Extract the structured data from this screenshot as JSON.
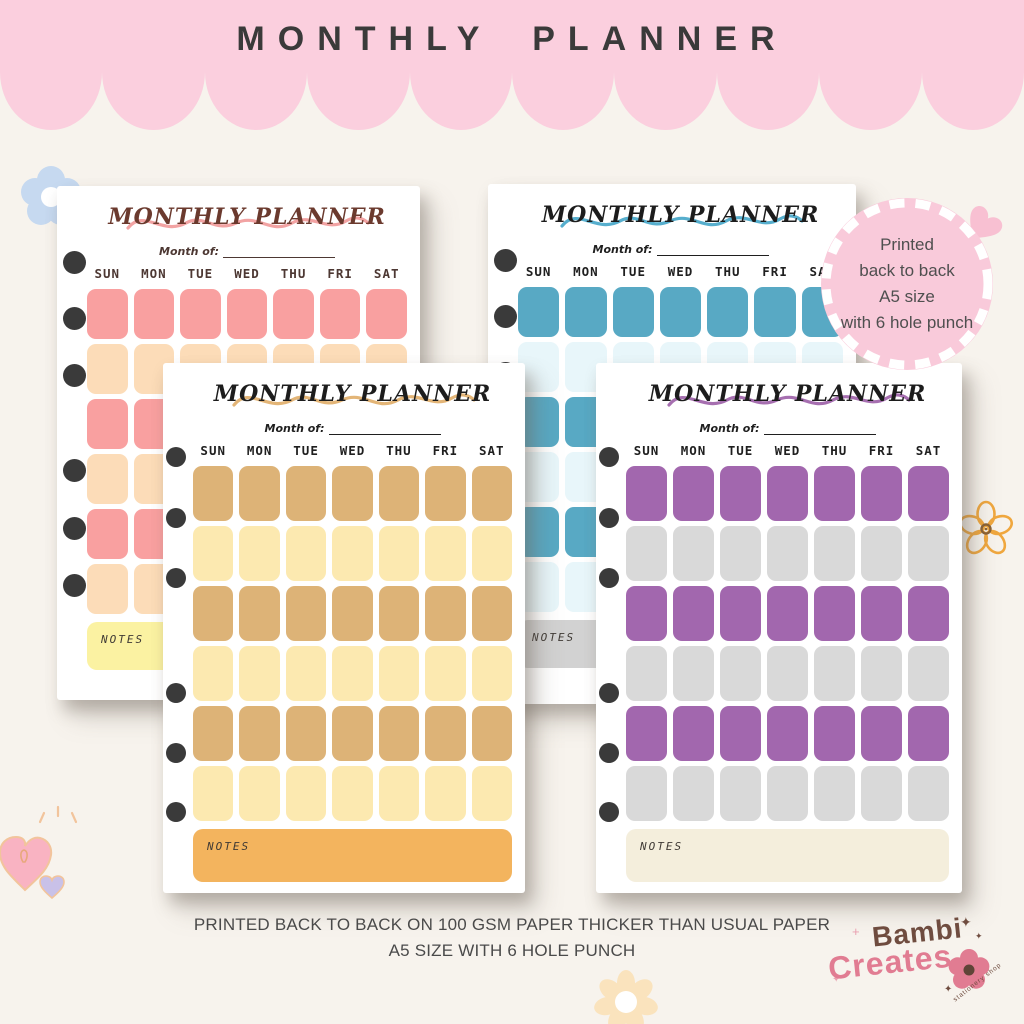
{
  "header": {
    "title": "MONTHLY PLANNER"
  },
  "badge": {
    "lines": [
      "Printed",
      "back to back",
      "A5 size",
      "with 6 hole punch"
    ]
  },
  "planners": [
    {
      "id": "pink",
      "title": "MONTHLY PLANNER",
      "month_label": "Month of:",
      "notes_label": "NOTES",
      "days": [
        "SUN",
        "MON",
        "TUE",
        "WED",
        "THU",
        "FRI",
        "SAT"
      ],
      "colors": {
        "primary": "#F9A0A0",
        "secondary": "#FCDCB8",
        "notes": "#FBF2A2",
        "title": "#6B3A2E",
        "day_text": "#4D3833",
        "squiggle": "#F2A3A3"
      }
    },
    {
      "id": "teal",
      "title": "MONTHLY PLANNER",
      "month_label": "Month of:",
      "notes_label": "NOTES",
      "days": [
        "SUN",
        "MON",
        "TUE",
        "WED",
        "THU",
        "FRI",
        "SAT"
      ],
      "colors": {
        "primary": "#58A9C4",
        "secondary": "#E8F6FA",
        "notes": "#D2D2D2",
        "title": "#1C1C1C",
        "day_text": "#1F1F1F",
        "squiggle": "#56AECD"
      }
    },
    {
      "id": "tan",
      "title": "MONTHLY PLANNER",
      "month_label": "Month of:",
      "notes_label": "NOTES",
      "days": [
        "SUN",
        "MON",
        "TUE",
        "WED",
        "THU",
        "FRI",
        "SAT"
      ],
      "colors": {
        "primary": "#DDB377",
        "secondary": "#FCE9B0",
        "notes": "#F3B45E",
        "title": "#1C1C1C",
        "day_text": "#1F1F1F",
        "squiggle": "#E3B577"
      }
    },
    {
      "id": "purple",
      "title": "MONTHLY PLANNER",
      "month_label": "Month of:",
      "notes_label": "NOTES",
      "days": [
        "SUN",
        "MON",
        "TUE",
        "WED",
        "THU",
        "FRI",
        "SAT"
      ],
      "colors": {
        "primary": "#A267AE",
        "secondary": "#D9D9D9",
        "notes": "#F4EEDC",
        "title": "#1C1C1C",
        "day_text": "#1F1F1F",
        "squiggle": "#A66FB0"
      }
    }
  ],
  "footer": {
    "line1": "PRINTED BACK TO BACK ON 100 GSM PAPER THICKER THAN USUAL PAPER",
    "line2": "A5 SIZE WITH 6 HOLE PUNCH"
  },
  "logo": {
    "word1": "Bambi",
    "word2": "Creates",
    "tagline": "stationery shop"
  },
  "colors": {
    "background": "#F7F3ED",
    "header_pink": "#FBCFDE",
    "header_text": "#3A3A3A",
    "badge_fill": "#F9CADA",
    "badge_text": "#4F4F4F",
    "hole_punch": "#3A3A3A",
    "footer_text": "#4A4A4A",
    "logo_brown": "#6F4C3F",
    "logo_pink": "#E17C92"
  },
  "decorations": {
    "blue_flower": "#C6D9F0",
    "outline_flower": "#F0A73E",
    "outline_flower_center": "#8A6134",
    "cream_flower": "#FAE3BD",
    "pink_heart": "#F9B3C2",
    "lavender_heart": "#C9C1E8",
    "heart_outline": "#F2C49C",
    "badge_heart": "#F8C0D2",
    "sparkle_pink": "#E9A0B0"
  }
}
